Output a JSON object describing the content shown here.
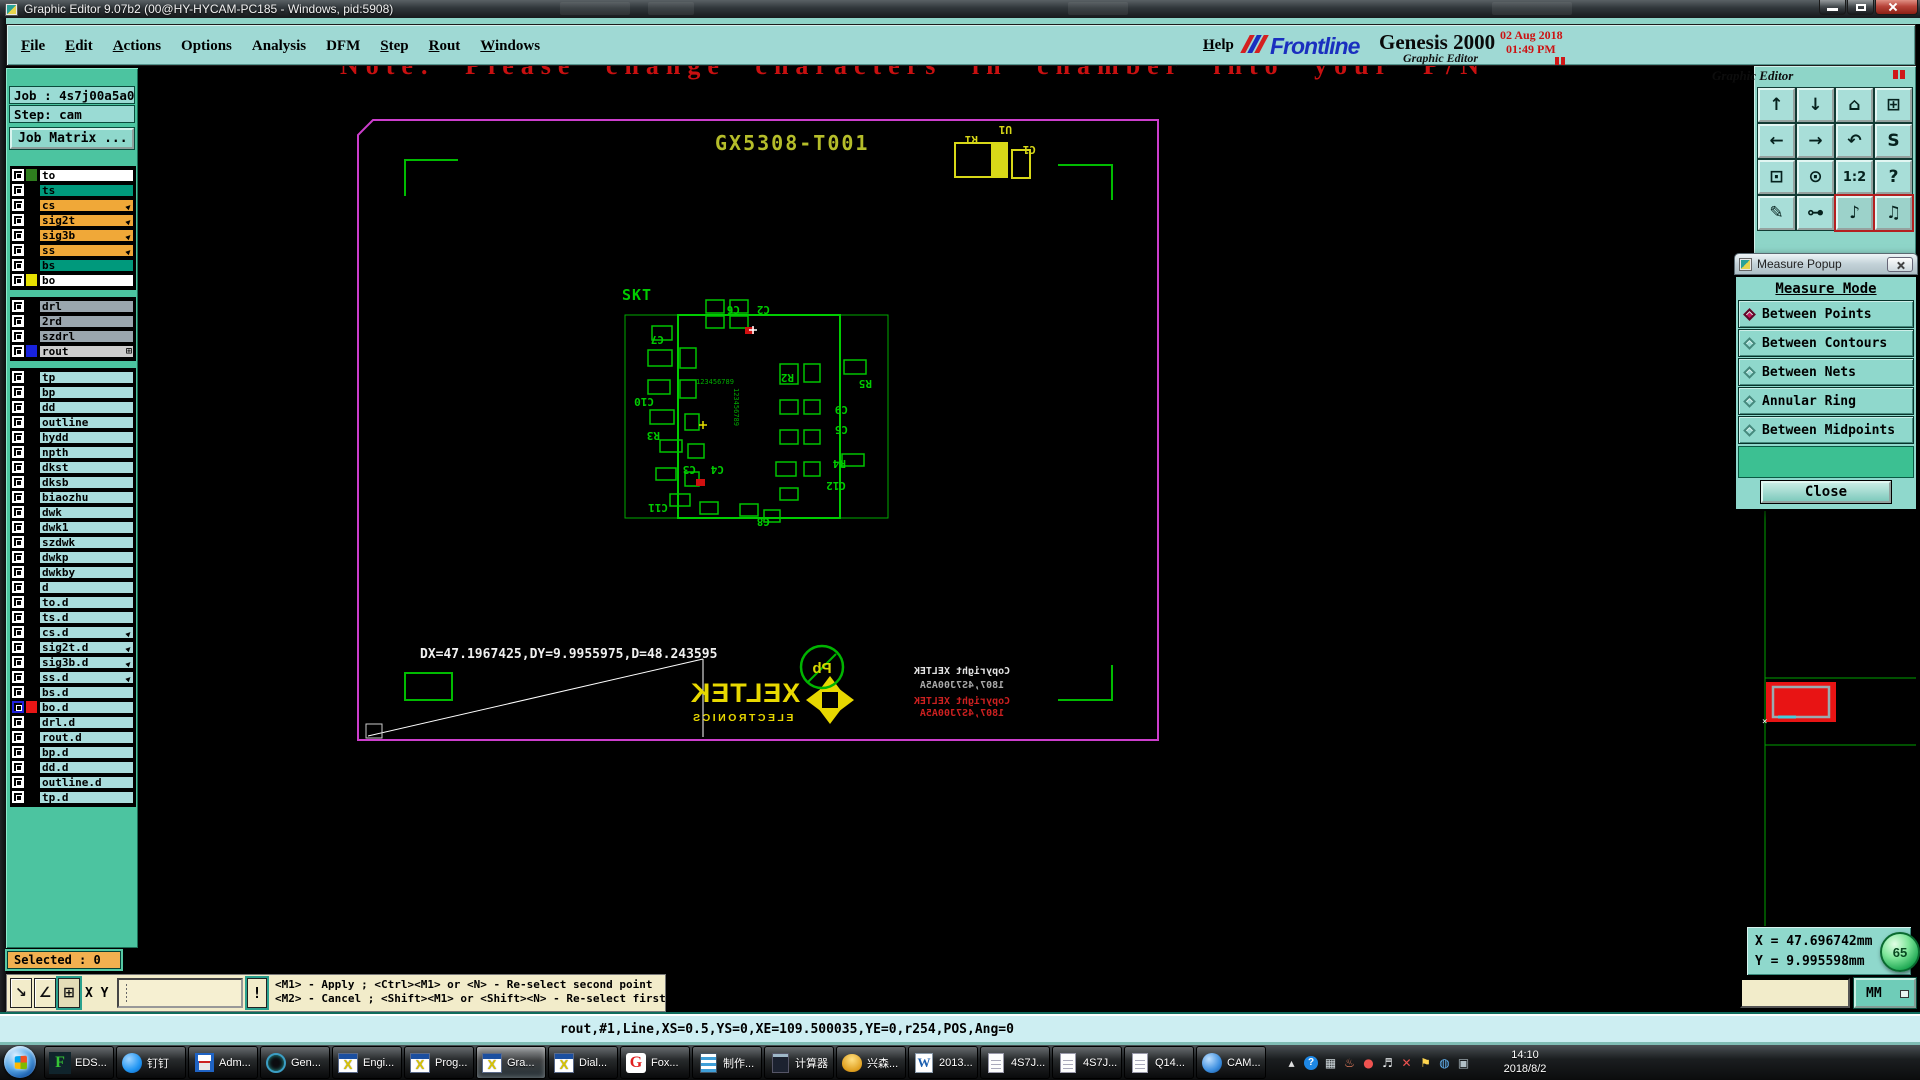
{
  "window": {
    "title": "Graphic Editor 9.07b2 (00@HY-HYCAM-PC185 - Windows, pid:5908)"
  },
  "menu": {
    "items": [
      {
        "label": "File",
        "u": true
      },
      {
        "label": "Edit",
        "u": true
      },
      {
        "label": "Actions",
        "u": true
      },
      {
        "label": "Options",
        "u": false
      },
      {
        "label": "Analysis",
        "u": false
      },
      {
        "label": "DFM",
        "u": false
      },
      {
        "label": "Step",
        "u": true
      },
      {
        "label": "Rout",
        "u": true
      },
      {
        "label": "Windows",
        "u": true
      }
    ],
    "help": "Help"
  },
  "brand": {
    "name": "Frontline",
    "product": "Genesis 2000",
    "subtitle": "Graphic Editor",
    "date": "02 Aug 2018",
    "time": "01:49 PM"
  },
  "job": {
    "job": "Job : 4s7j00a5a0",
    "step": "Step: cam",
    "matrix": "Job Matrix ..."
  },
  "layers": {
    "groups": [
      {
        "rows": [
          {
            "name": "to",
            "bg": "#ffffff",
            "swatch": "#2e7d1e"
          },
          {
            "name": "ts",
            "bg": "#00997c",
            "swatch": "#000000"
          },
          {
            "name": "cs",
            "bg": "#f0a838",
            "swatch": "#000000",
            "arrow": true
          },
          {
            "name": "sig2t",
            "bg": "#f0a838",
            "swatch": "#000000",
            "arrow": true
          },
          {
            "name": "sig3b",
            "bg": "#f0a838",
            "swatch": "#000000",
            "arrow": true
          },
          {
            "name": "ss",
            "bg": "#f0a838",
            "swatch": "#000000",
            "arrow": true
          },
          {
            "name": "bs",
            "bg": "#00997c",
            "swatch": "#000000"
          },
          {
            "name": "bo",
            "bg": "#ffffff",
            "swatch": "#e6e000"
          }
        ]
      },
      {
        "rows": [
          {
            "name": "drl",
            "bg": "#9aa6ae",
            "swatch": "#000000"
          },
          {
            "name": "2rd",
            "bg": "#9aa6ae",
            "swatch": "#000000"
          },
          {
            "name": "szdrl",
            "bg": "#9aa6ae",
            "swatch": "#000000"
          },
          {
            "name": "rout",
            "bg": "#cccccc",
            "swatch": "#1822dd",
            "grid": true
          }
        ]
      },
      {
        "rows": [
          {
            "name": "tp",
            "bg": "#a9dcdc",
            "swatch": "#000000"
          },
          {
            "name": "bp",
            "bg": "#a9dcdc",
            "swatch": "#000000"
          },
          {
            "name": "dd",
            "bg": "#a9dcdc",
            "swatch": "#000000"
          },
          {
            "name": "outline",
            "bg": "#a9dcdc",
            "swatch": "#000000"
          },
          {
            "name": "hydd",
            "bg": "#a9dcdc",
            "swatch": "#000000"
          },
          {
            "name": "npth",
            "bg": "#a9dcdc",
            "swatch": "#000000"
          },
          {
            "name": "dkst",
            "bg": "#a9dcdc",
            "swatch": "#000000"
          },
          {
            "name": "dksb",
            "bg": "#a9dcdc",
            "swatch": "#000000"
          },
          {
            "name": "biaozhu",
            "bg": "#a9dcdc",
            "swatch": "#000000"
          },
          {
            "name": "dwk",
            "bg": "#a9dcdc",
            "swatch": "#000000"
          },
          {
            "name": "dwk1",
            "bg": "#a9dcdc",
            "swatch": "#000000"
          },
          {
            "name": "szdwk",
            "bg": "#a9dcdc",
            "swatch": "#000000"
          },
          {
            "name": "dwkp",
            "bg": "#a9dcdc",
            "swatch": "#000000"
          },
          {
            "name": "dwkby",
            "bg": "#a9dcdc",
            "swatch": "#000000"
          },
          {
            "name": "d",
            "bg": "#a9dcdc",
            "swatch": "#000000"
          },
          {
            "name": "to.d",
            "bg": "#a9dcdc",
            "swatch": "#000000"
          },
          {
            "name": "ts.d",
            "bg": "#a9dcdc",
            "swatch": "#000000"
          },
          {
            "name": "cs.d",
            "bg": "#a9dcdc",
            "swatch": "#000000",
            "arrow": true
          },
          {
            "name": "sig2t.d",
            "bg": "#a9dcdc",
            "swatch": "#000000",
            "arrow": true
          },
          {
            "name": "sig3b.d",
            "bg": "#a9dcdc",
            "swatch": "#000000",
            "arrow": true
          },
          {
            "name": "ss.d",
            "bg": "#a9dcdc",
            "swatch": "#000000",
            "arrow": true
          },
          {
            "name": "bs.d",
            "bg": "#a9dcdc",
            "swatch": "#000000"
          },
          {
            "name": "bo.d",
            "bg": "#a9dcdc",
            "swatch": "#e81616",
            "active": true
          },
          {
            "name": "drl.d",
            "bg": "#a9dcdc",
            "swatch": "#000000"
          },
          {
            "name": "rout.d",
            "bg": "#a9dcdc",
            "swatch": "#000000"
          },
          {
            "name": "bp.d",
            "bg": "#a9dcdc",
            "swatch": "#000000"
          },
          {
            "name": "dd.d",
            "bg": "#a9dcdc",
            "swatch": "#000000"
          },
          {
            "name": "outline.d",
            "bg": "#a9dcdc",
            "swatch": "#000000"
          },
          {
            "name": "tp.d",
            "bg": "#a9dcdc",
            "swatch": "#000000"
          }
        ]
      }
    ]
  },
  "selected": "Selected : 0",
  "xy": {
    "label": "X Y :",
    "value": "",
    "bang": "!",
    "icons": [
      {
        "g": "↘",
        "n": "diag-line-mode"
      },
      {
        "g": "∠",
        "n": "angle-snap-mode"
      },
      {
        "g": "⊞",
        "n": "grid-snap-mode",
        "active": true
      }
    ],
    "hint1": "<M1> - Apply  ; <Ctrl><M1> or <N> - Re-select second point",
    "hint2": "<M2> - Cancel ; <Shift><M1> or <Shift><N> - Re-select first point"
  },
  "command": "rout,#1,Line,XS=0.5,YS=0,XE=109.500035,YE=0,r254,POS,Ang=0",
  "canvas": {
    "note": "Note: Please change characters in chamber into your P/N",
    "board_title": "GX5308-T001",
    "skt": "SKT",
    "measure_text": "DX=47.1967425,DY=9.9955975,D=48.243595",
    "logo": "XELTEK",
    "logo_sub": "ELECTRONICS",
    "pb": "Pb",
    "copyright": [
      "Copyright XELTEK",
      "1807,4S7J00A5A"
    ],
    "digits": "123456789",
    "top_refs": [
      {
        "t": "R1",
        "x": 838,
        "y": 70
      },
      {
        "t": "U1",
        "x": 872,
        "y": 60
      },
      {
        "t": "C1",
        "x": 896,
        "y": 80
      }
    ],
    "ref_labels": [
      {
        "t": "C6",
        "x": 600,
        "y": 240
      },
      {
        "t": "C2",
        "x": 630,
        "y": 240
      },
      {
        "t": "C7",
        "x": 524,
        "y": 270
      },
      {
        "t": "R2",
        "x": 654,
        "y": 308
      },
      {
        "t": "C10",
        "x": 514,
        "y": 332
      },
      {
        "t": "R3",
        "x": 520,
        "y": 366
      },
      {
        "t": "C3",
        "x": 556,
        "y": 400
      },
      {
        "t": "C4",
        "x": 584,
        "y": 400
      },
      {
        "t": "C11",
        "x": 528,
        "y": 438
      },
      {
        "t": "C8",
        "x": 630,
        "y": 452
      },
      {
        "t": "R5",
        "x": 732,
        "y": 314
      },
      {
        "t": "C9",
        "x": 708,
        "y": 340
      },
      {
        "t": "C5",
        "x": 708,
        "y": 360
      },
      {
        "t": "R4",
        "x": 706,
        "y": 394
      },
      {
        "t": "C12",
        "x": 706,
        "y": 416
      }
    ]
  },
  "measure_popup": {
    "title": "Measure Popup",
    "header": "Measure Mode",
    "options": [
      {
        "label": "Between Points",
        "selected": true
      },
      {
        "label": "Between Contours"
      },
      {
        "label": "Between Nets"
      },
      {
        "label": "Annular Ring"
      },
      {
        "label": "Between Midpoints"
      }
    ],
    "close": "Close"
  },
  "right_toolbar": {
    "rows": [
      [
        {
          "g": "↑",
          "n": "pan-up"
        },
        {
          "g": "↓",
          "n": "pan-down"
        },
        {
          "g": "⌂",
          "n": "home-view"
        },
        {
          "g": "⊞",
          "n": "window-xy"
        }
      ],
      [
        {
          "g": "←",
          "n": "pan-left"
        },
        {
          "g": "→",
          "n": "pan-right"
        },
        {
          "g": "↶",
          "n": "undo-view"
        },
        {
          "g": "S",
          "n": "s-shape"
        }
      ],
      [
        {
          "g": "⊡",
          "n": "zoom-fit"
        },
        {
          "g": "⊙",
          "n": "zoom-center"
        },
        {
          "g": "1:2",
          "n": "zoom-ratio",
          "small": true
        },
        {
          "g": "?",
          "n": "help-tool"
        }
      ],
      [
        {
          "g": "✎",
          "n": "edit-tools"
        },
        {
          "g": "⊶",
          "n": "net-node-tool"
        },
        {
          "g": "♪",
          "n": "layer-stack-a",
          "active": true
        },
        {
          "g": "♫",
          "n": "layer-stack-b",
          "active": true
        }
      ]
    ]
  },
  "readout": {
    "x": "X = 47.696742mm",
    "y": "Y = 9.995598mm",
    "badge": "65",
    "units": "MM"
  },
  "taskbar": {
    "items": [
      {
        "label": "EDS...",
        "icon": "eds"
      },
      {
        "label": "钉钉",
        "icon": "ding"
      },
      {
        "label": "Adm...",
        "icon": "save"
      },
      {
        "label": "Gen...",
        "icon": "gen"
      },
      {
        "label": "Engi...",
        "icon": "xwin"
      },
      {
        "label": "Prog...",
        "icon": "xwin"
      },
      {
        "label": "Gra...",
        "icon": "xwin",
        "active": true
      },
      {
        "label": "Dial...",
        "icon": "xwin"
      },
      {
        "label": "Fox...",
        "icon": "fox"
      },
      {
        "label": "制作...",
        "icon": "docblue"
      },
      {
        "label": "计算器",
        "icon": "calc"
      },
      {
        "label": "兴森...",
        "icon": "shell"
      },
      {
        "label": "2013...",
        "icon": "wdoc"
      },
      {
        "label": "4S7J...",
        "icon": "txt"
      },
      {
        "label": "4S7J...",
        "icon": "txt"
      },
      {
        "label": "Q14...",
        "icon": "txt"
      },
      {
        "label": "CAM...",
        "icon": "globe"
      }
    ],
    "tray": [
      {
        "g": "▴",
        "c": "#e0e0e0",
        "n": "show-hidden-icons"
      },
      {
        "g": "?",
        "c": "#ffffff",
        "bg": "#1e88e5",
        "n": "help-tray-icon"
      },
      {
        "g": "▦",
        "c": "#cfd8dc",
        "n": "app-tray-icon"
      },
      {
        "g": "♨",
        "c": "#ff8a65",
        "n": "app-tray-icon-2"
      },
      {
        "g": "●",
        "c": "#ef5350",
        "n": "status-tray-icon"
      },
      {
        "g": "♬",
        "c": "#eceff1",
        "n": "media-tray-icon"
      },
      {
        "g": "✕",
        "c": "#ef5350",
        "n": "error-tray-icon"
      },
      {
        "g": "⚑",
        "c": "#ffd54f",
        "n": "flag-tray-icon"
      },
      {
        "g": "◍",
        "c": "#64b5f6",
        "n": "network-tray-icon"
      },
      {
        "g": "▣",
        "c": "#b0bec5",
        "n": "volume-tray-icon"
      }
    ],
    "clock": {
      "time": "14:10",
      "date": "2018/8/2"
    }
  }
}
